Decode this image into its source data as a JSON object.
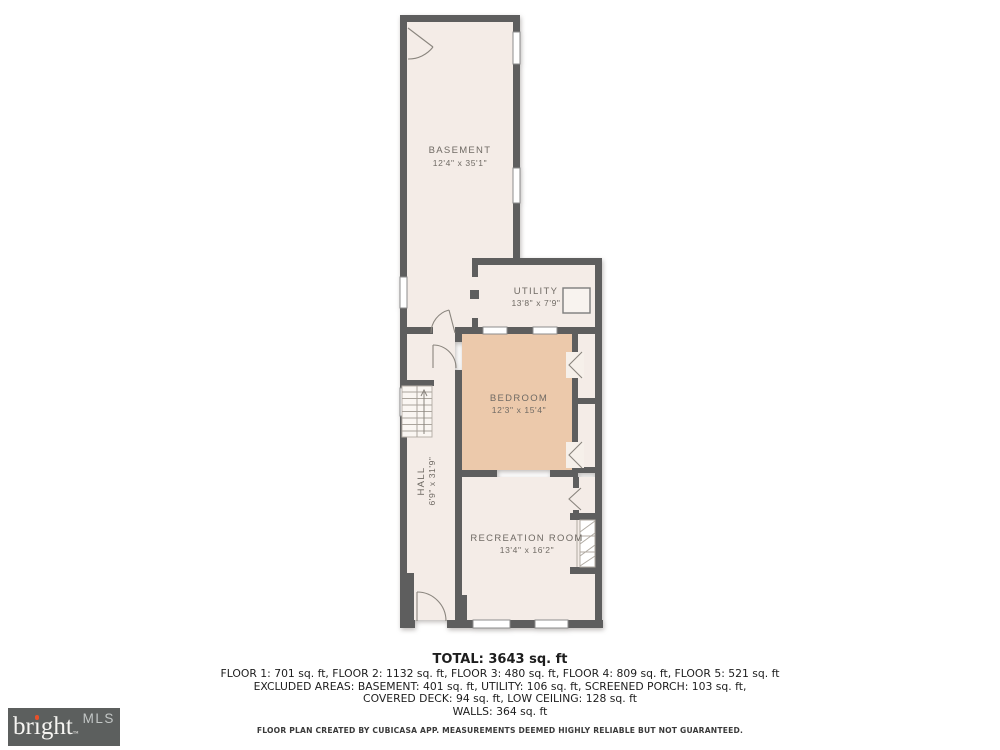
{
  "plan": {
    "rooms": [
      {
        "name": "BASEMENT",
        "dims": "12'4\" x 35'1\""
      },
      {
        "name": "UTILITY",
        "dims": "13'8\" x 7'9\""
      },
      {
        "name": "BEDROOM",
        "dims": "12'3\" x 15'4\""
      },
      {
        "name": "HALL",
        "dims": "6'9\" x 31'9\""
      },
      {
        "name": "RECREATION ROOM",
        "dims": "13'4\" x 16'2\""
      }
    ]
  },
  "summary": {
    "total": "TOTAL: 3643 sq. ft",
    "floors": "FLOOR 1: 701 sq. ft, FLOOR 2: 1132 sq. ft, FLOOR 3: 480 sq. ft, FLOOR 4: 809 sq. ft, FLOOR 5: 521 sq. ft",
    "excluded1": "EXCLUDED AREAS: BASEMENT: 401 sq. ft, UTILITY: 106 sq. ft, SCREENED PORCH: 103 sq. ft,",
    "excluded2": "COVERED DECK: 94 sq. ft, LOW CEILING: 128 sq. ft",
    "walls": "WALLS: 364 sq. ft"
  },
  "disclaimer": "FLOOR PLAN CREATED BY CUBICASA APP. MEASUREMENTS DEEMED HIGHLY RELIABLE BUT NOT GUARANTEED.",
  "logo": {
    "brand_pre": "br",
    "brand_i": "ı",
    "brand_post": "ght",
    "trademark": "™",
    "suffix": "MLS"
  },
  "colors": {
    "wall": "#5e5e5e",
    "room_fill": "#f4ece7",
    "bedroom_fill": "#ecc9ab",
    "logo_bg": "#5c5f5e",
    "logo_accent": "#e8502a"
  }
}
